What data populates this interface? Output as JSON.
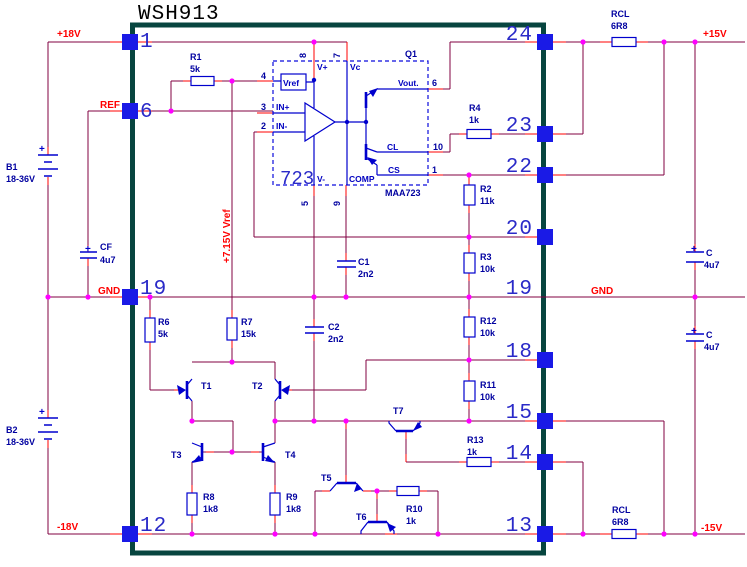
{
  "title": "WSH913",
  "colors": {
    "wire": "#800040",
    "terminal_stub": "#ff0000",
    "junction_dot": "#ff00ff",
    "device_blue": "#0000cd",
    "pin_pad": "#1a1ae6",
    "module_border": "#07453f",
    "net_label": "#ff0000",
    "component_label": "#0000a0",
    "background": "#ffffff"
  },
  "nets": {
    "plus18": "+18V",
    "ref": "REF",
    "gnd_left": "GND",
    "minus18": "-18V",
    "plus15": "+15V",
    "gnd_right": "GND",
    "minus15": "-15V",
    "vref_rail": "+7.15V Vref"
  },
  "pins": {
    "l1": "1",
    "l6": "6",
    "l19": "19",
    "l12": "12",
    "r24": "24",
    "r23": "23",
    "r22": "22",
    "r20": "20",
    "r19": "19",
    "r18": "18",
    "r15": "15",
    "r14": "14",
    "r13": "13"
  },
  "ic": {
    "designator": "Q1",
    "part": "MAA723",
    "core": "723",
    "labels": {
      "vref": "Vref",
      "vplus": "V+",
      "vc": "Vc",
      "inp": "IN+",
      "inn": "IN-",
      "vminus": "V-",
      "comp": "COMP",
      "vout": "Vout.",
      "cl": "CL",
      "cs": "CS"
    },
    "pin_numbers": {
      "n8": "8",
      "n7": "7",
      "n4": "4",
      "n3": "3",
      "n2": "2",
      "n6": "6",
      "n10": "10",
      "n1": "1",
      "n5": "5",
      "n9": "9"
    }
  },
  "components": {
    "R1": {
      "ref": "R1",
      "value": "5k"
    },
    "R2": {
      "ref": "R2",
      "value": "11k"
    },
    "R3": {
      "ref": "R3",
      "value": "10k"
    },
    "R4": {
      "ref": "R4",
      "value": "1k"
    },
    "R6": {
      "ref": "R6",
      "value": "5k"
    },
    "R7": {
      "ref": "R7",
      "value": "15k"
    },
    "R8": {
      "ref": "R8",
      "value": "1k8"
    },
    "R9": {
      "ref": "R9",
      "value": "1k8"
    },
    "R10": {
      "ref": "R10",
      "value": "1k"
    },
    "R11": {
      "ref": "R11",
      "value": "10k"
    },
    "R12": {
      "ref": "R12",
      "value": "10k"
    },
    "R13": {
      "ref": "R13",
      "value": "1k"
    },
    "RCL_top": {
      "ref": "RCL",
      "value": "6R8"
    },
    "RCL_bottom": {
      "ref": "RCL",
      "value": "6R8"
    },
    "C1": {
      "ref": "C1",
      "value": "2n2"
    },
    "C2": {
      "ref": "C2",
      "value": "2n2"
    },
    "CF": {
      "ref": "CF",
      "value": "4u7"
    },
    "C_top": {
      "ref": "C",
      "value": "4u7"
    },
    "C_bottom": {
      "ref": "C",
      "value": "4u7"
    },
    "B1": {
      "ref": "B1",
      "value": "18-36V"
    },
    "B2": {
      "ref": "B2",
      "value": "18-36V"
    },
    "T1": {
      "ref": "T1"
    },
    "T2": {
      "ref": "T2"
    },
    "T3": {
      "ref": "T3"
    },
    "T4": {
      "ref": "T4"
    },
    "T5": {
      "ref": "T5"
    },
    "T6": {
      "ref": "T6"
    },
    "T7": {
      "ref": "T7"
    }
  },
  "symbols": {
    "plus": "+"
  }
}
